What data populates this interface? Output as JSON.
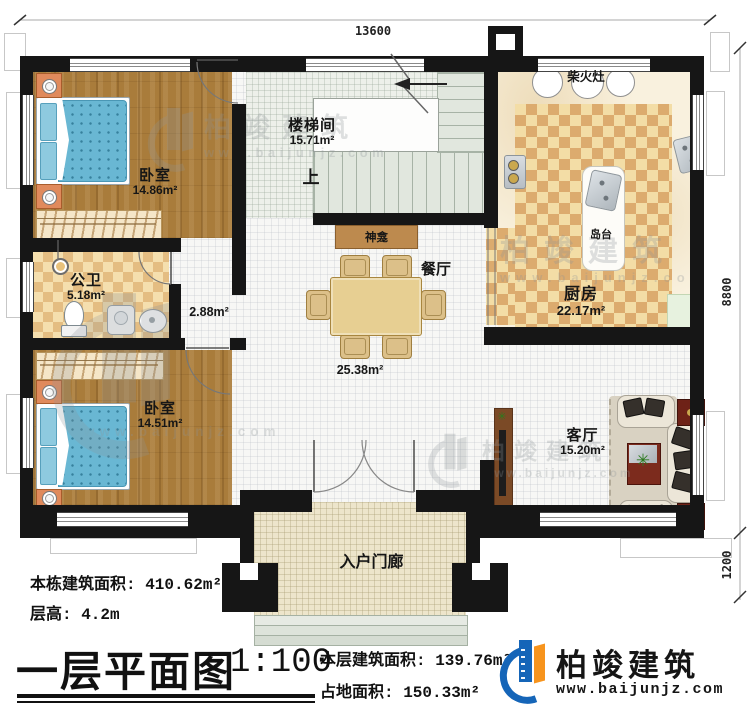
{
  "dimensions": {
    "width_top": "13600",
    "height_main": "8800",
    "height_porch": "1200"
  },
  "rooms": {
    "bedroom1": {
      "name": "卧室",
      "area": "14.86m²"
    },
    "bedroom2": {
      "name": "卧室",
      "area": "14.51m²"
    },
    "stairwell": {
      "name": "楼梯间",
      "area": "15.71m²",
      "up_label": "上"
    },
    "kitchen": {
      "name": "厨房",
      "area": "22.17m²",
      "wood_stove": "柴火灶",
      "island": "岛台"
    },
    "bathroom": {
      "name": "公卫",
      "area": "5.18m²"
    },
    "hallway": {
      "area": "2.88m²"
    },
    "dining": {
      "name": "餐厅",
      "area": "25.38m²",
      "shrine": "神龛"
    },
    "living": {
      "name": "客厅",
      "area": "15.20m²"
    },
    "porch": {
      "name": "入户门廊"
    }
  },
  "info": {
    "total_area_label": "本栋建筑面积: 410.62m²",
    "floor_height_label": "层高: 4.2m"
  },
  "title_block": {
    "title": "一层平面图",
    "scale": "1:100",
    "floor_area_label": "本层建筑面积: 139.76m²",
    "footprint_label": "占地面积: 150.33m²"
  },
  "brand": {
    "name": "柏竣建筑",
    "website": "www.baijunjz.com"
  },
  "watermark": {
    "name": "柏竣建筑",
    "website": "www.baijunjz.com"
  },
  "colors": {
    "wall": "#161616",
    "wood_floor": "#a97c3b",
    "bed_blue": "#69b7d3",
    "kitchen_rug_dark": "#dcab6e",
    "kitchen_rug_light": "#f3dda6",
    "logo_blue": "#1565b8",
    "logo_orange": "#f7941d",
    "coffee_table_red": "#7c2b1d"
  }
}
